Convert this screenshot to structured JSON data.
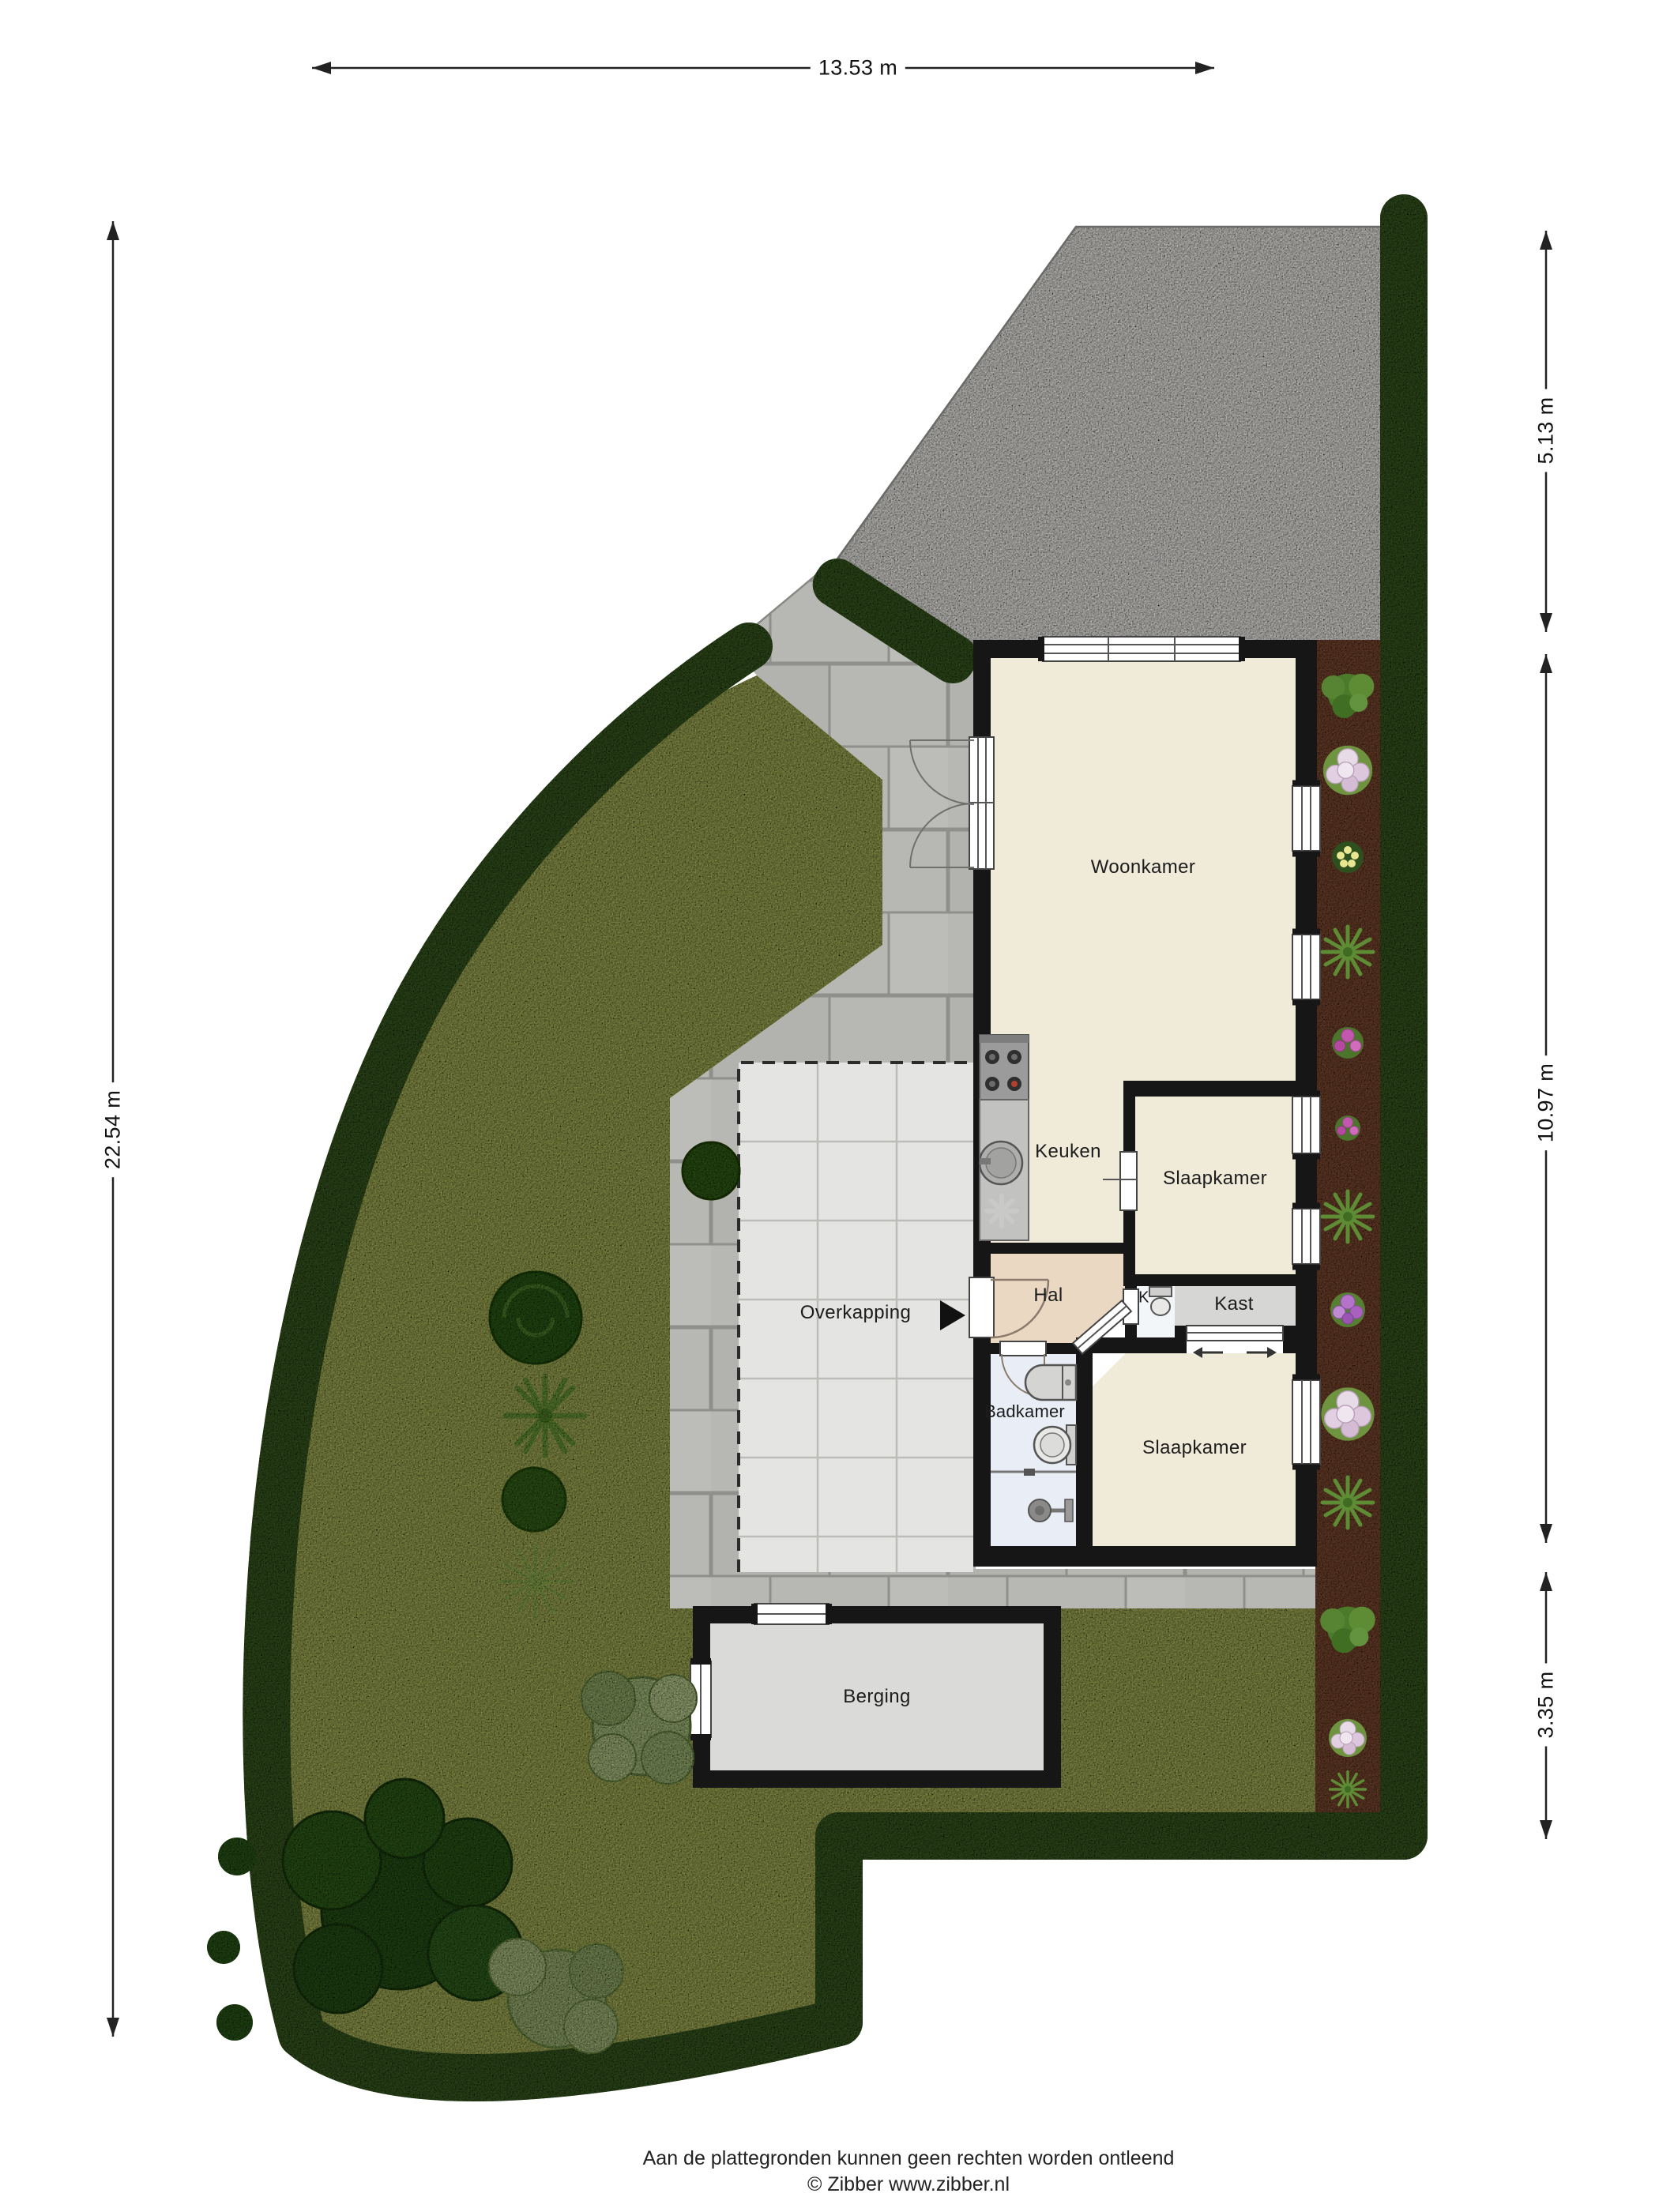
{
  "page": {
    "footer_line1": "Aan de plattegronden kunnen geen rechten worden ontleend",
    "footer_line2": "© Zibber www.zibber.nl"
  },
  "dimensions": {
    "width_total": "13.53 m",
    "height_total": "22.54 m",
    "right_top": "5.13 m",
    "right_middle": "10.97 m",
    "right_bottom": "3.35 m"
  },
  "rooms": {
    "woonkamer": "Woonkamer",
    "keuken": "Keuken",
    "slaapkamer_1": "Slaapkamer",
    "hal": "Hal",
    "toilet_k": "K",
    "kast": "Kast",
    "badkamer": "Badkamer",
    "slaapkamer_2": "Slaapkamer",
    "overkapping": "Overkapping",
    "berging": "Berging"
  },
  "colors": {
    "grass": "#a3ad58",
    "hedge": "#3c5c25",
    "gravel": "#ebeae6",
    "soil": "#7c4c34",
    "wall": "#161616",
    "floor_main": "#f0ead9",
    "floor_hal": "#ead8c3",
    "floor_kast": "#d6d6d4",
    "floor_toilet": "#f3f6f8",
    "floor_badkamer": "#e9eef6",
    "floor_berging": "#dadad8",
    "overkapping_tile": "#e4e4e2"
  }
}
